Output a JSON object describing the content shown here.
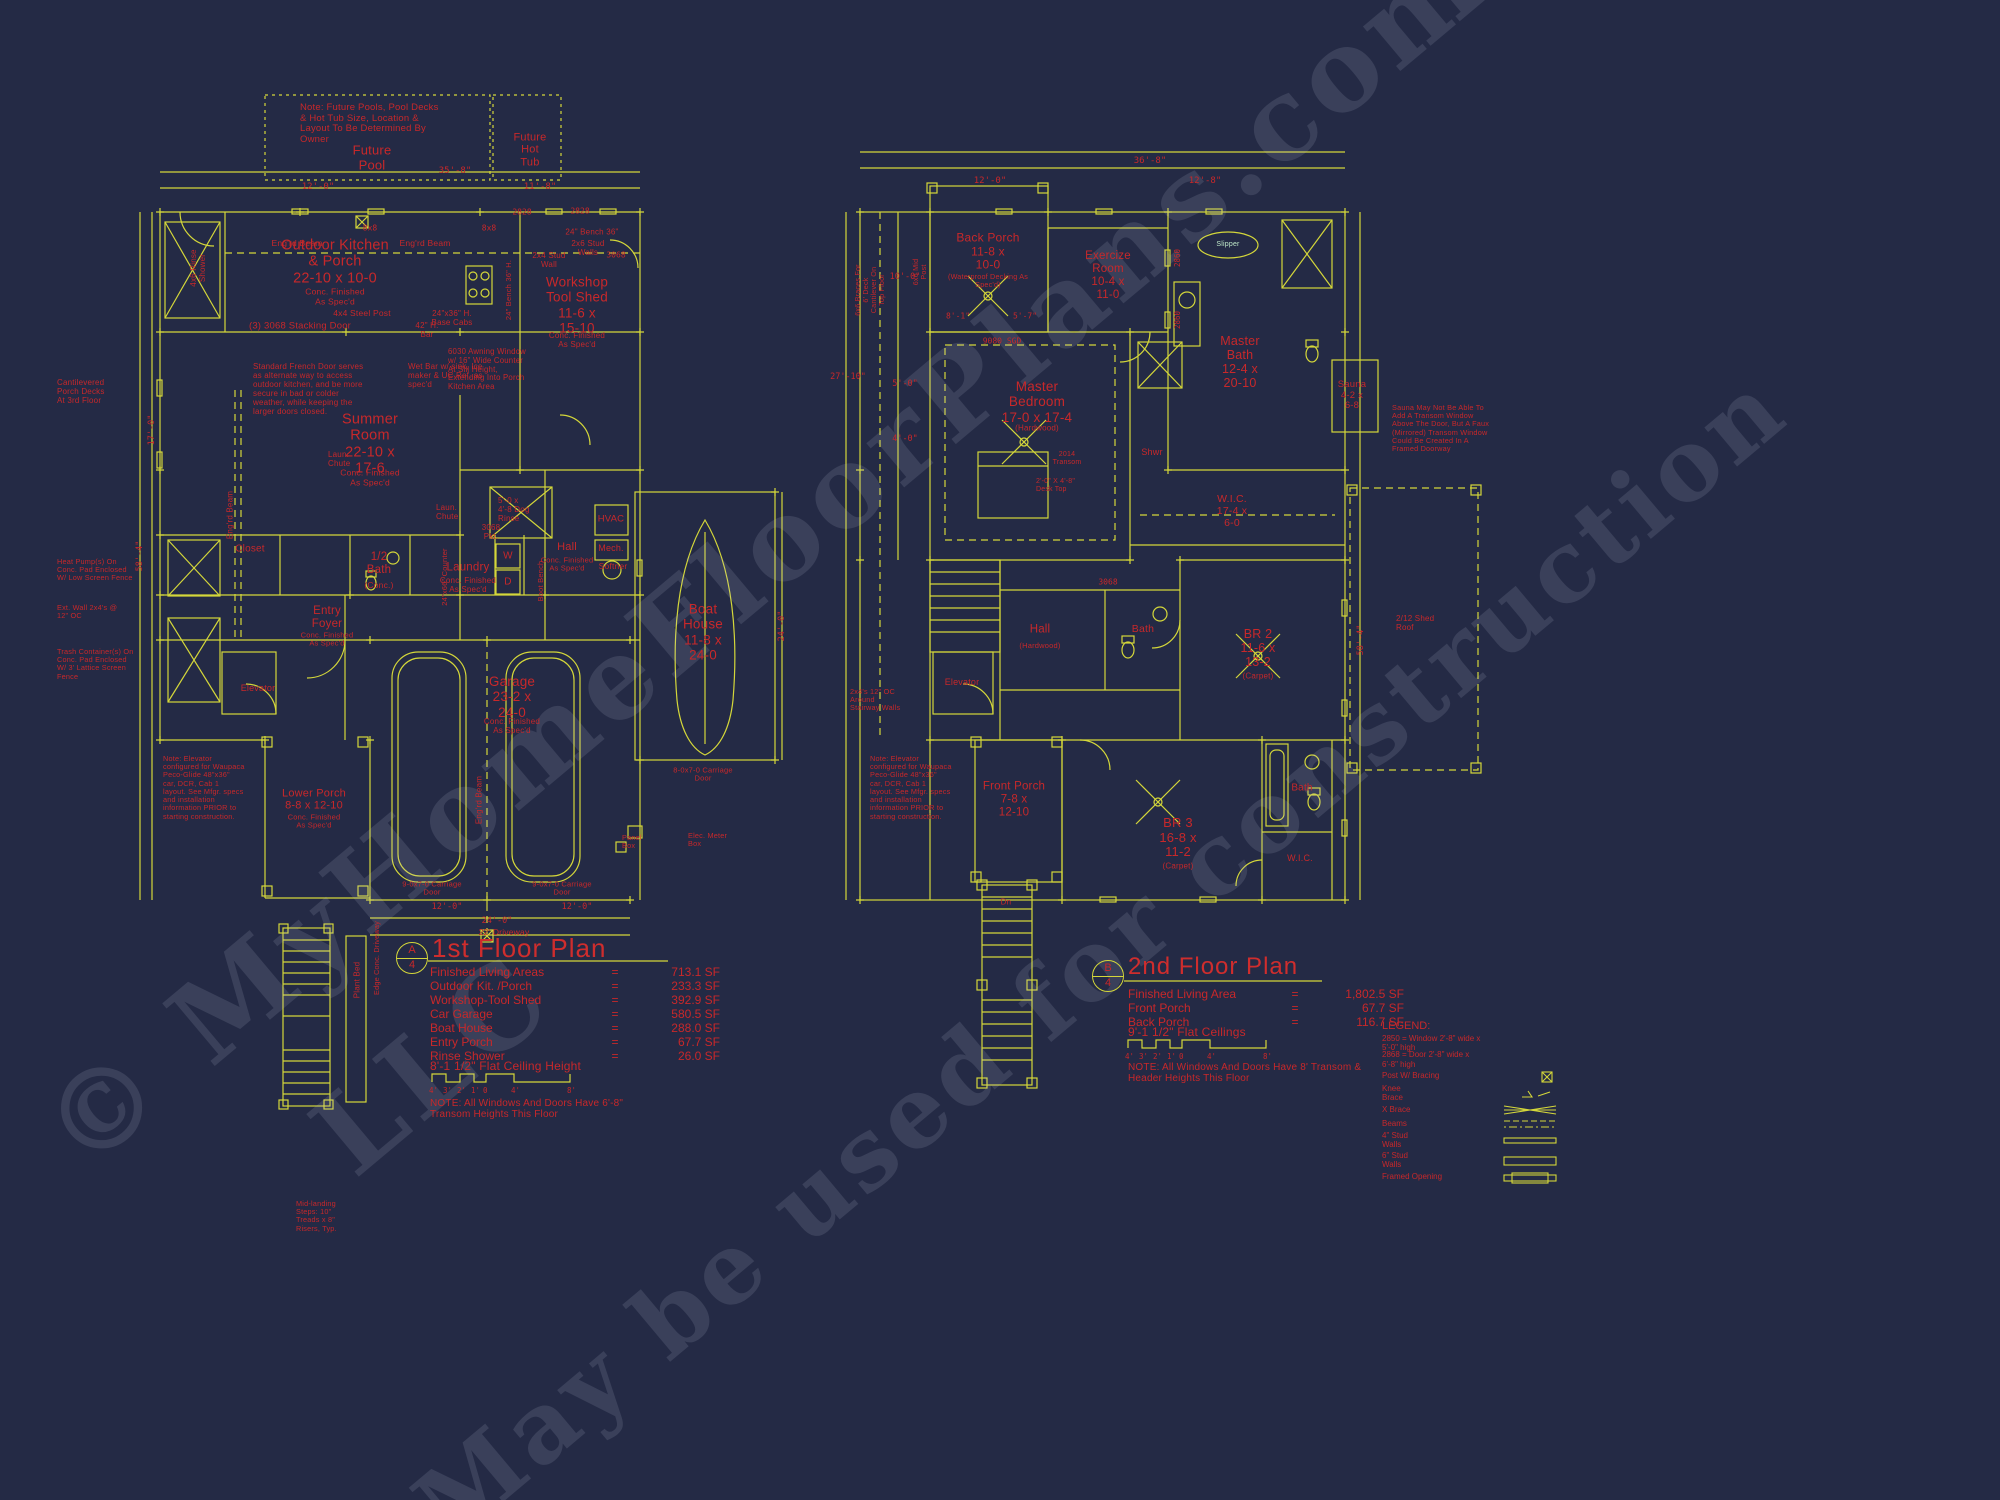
{
  "wm": {
    "l1": "© MyHomeFloorPlans.com",
    "l2": "LLC",
    "l3": "May be used for construction"
  },
  "p1": {
    "future_note": "Note: Future Pools, Pool Decks\n& Hot Tub Size, Location &\nLayout To Be Determined By\nOwner",
    "future_pool": "Future\nPool",
    "future_hot_tub": "Future\nHot\nTub",
    "outdoor_kitchen": "Outdoor Kitchen\n& Porch\n22-10 x 10-0",
    "outdoor_kitchen_fin": "Conc. Finished\nAs Spec'd",
    "workshop": "Workshop\nTool Shed\n11-6 x\n15-10",
    "workshop_fin": "Conc. Finished\nAs Spec'd",
    "summer_room": "Summer\nRoom\n22-10 x\n17-6",
    "summer_room_fin": "Conc. Finished\nAs Spec'd",
    "entry_foyer": "Entry\nFoyer",
    "entry_foyer_fin": "Conc. Finished\nAs Spec'd",
    "closet": "Closet",
    "elevator": "Elevator",
    "half_bath": "1/2\nBath",
    "half_bath_fin": "(Conc.)",
    "laundry": "Laundry",
    "laundry_fin": "Conc. Finished\nAs Spec'd",
    "washer": "W",
    "dryer": "D",
    "hall": "Hall",
    "hall_fin": "Conc. Finished\nAs Spec'd",
    "dog_rinse": "5'-0 x\n4'-8 Dog\nRinse",
    "hvac": "HVAC",
    "mech": "Mech.",
    "softner": "Softner",
    "boat_house": "Boat\nHouse\n11-8 x\n24-0",
    "boot_bench": "Boot Bench",
    "garage": "Garage\n23-2 x\n24-0",
    "garage_fin": "Conc. Finished\nAs Spec'd",
    "lower_porch": "Lower Porch\n8-8 x 12-10",
    "lower_porch_fin": "Conc. Finished\nAs Spec'd",
    "rinse_shower": "4x6 Rinse\nShower",
    "notes": {
      "cantilever": "Cantilevered\nPorch Decks\nAt 3rd Floor",
      "heat_pump": "Heat Pump(s) On\nConc. Pad Enclosed\nW/ Low Screen Fence",
      "ext_wall": "Ext. Wall 2x4's @\n12\" OC",
      "trash": "Trash Container(s) On\nConc. Pad Enclosed\nW/ 3' Lattice Screen\nFence",
      "elevator_note": "Note: Elevator\nconfigured for Waupaca\nPeco-Glide 48\"x36\"\ncar, DCR, Cab 1\nlayout. See Mfgr. specs\nand installation\ninformation PRIOR to\nstarting construction.",
      "french_door": "Standard French Door serves\nas alternate way to access\noutdoor kitchen, and be more\nsecure in bad or colder\nweather, while keeping the\nlarger doors closed.",
      "awning": "6030 Awning Window\nw/ 16\" Wide Counter\nAt Sill Height,\nExtending Into Porch\nKitchen Area",
      "base_cabs": "24\"x36\" H.\nBase Cabs",
      "stacking_door": "(3) 3068 Stacking Door",
      "steel_post": "4x4 Steel Post",
      "engrd_beam": "Eng'rd Beam",
      "bench24": "24\" Bench 36\"",
      "stud_walls": "2x6 Stud\nWalls",
      "stud24": "2x4 Stud\nWall",
      "bench_vert": "24\" Bench 36\" H.",
      "wet_bar": "Wet Bar w/ sink, Ice\nmaker & UC Ref. as\nspec'd",
      "bar42": "42\" H.\nBar",
      "laun_chute": "Laun.\nChute",
      "counter24": "24\"x66\" Counter",
      "mid_landing": "Mid-landing\nSteps: 10\"\nTreads x 8\"\nRisers, Typ.",
      "plant_bed": "Plant Bed",
      "edge_conc": "Edge Conc. Driveway",
      "elec_meter": "Elec. Meter\nBox",
      "panel_box": "Panel\nBox",
      "driveway": "22' Driveway"
    },
    "dims": {
      "top_l": "12'-0\"",
      "top_r": "11'-8\"",
      "top_total": "35'-8\"",
      "left_total": "58'-4\"",
      "left_mid": "17'-0\"",
      "boat_r": "24'-0\"",
      "gar_l": "12'-0\"",
      "gar_r": "12'-0\"",
      "gar_total": "24'-0\""
    },
    "codes": {
      "w2828a": "2828",
      "w2828b": "2828",
      "d3068a": "3068",
      "pkt": "3068\nPkt.",
      "p8x8a": "8x8",
      "p8x8b": "8x8",
      "carriage_l": "9-0x7-0 Carriage\nDoor",
      "carriage_r": "9-0x7-0 Carriage\nDoor",
      "boat_door": "8-0x7-0 Carriage\nDoor"
    },
    "title": "1st Floor Plan",
    "marker_letter": "A",
    "marker_number": "4",
    "summary": {
      "rows": [
        {
          "label": "Finished Living Areas",
          "eq": "=",
          "value": "713.1 SF"
        },
        {
          "label": "Outdoor Kit. /Porch",
          "eq": "=",
          "value": "233.3 SF"
        },
        {
          "label": "Workshop-Tool Shed",
          "eq": "=",
          "value": "392.9 SF"
        },
        {
          "label": "Car Garage",
          "eq": "=",
          "value": "580.5 SF"
        },
        {
          "label": "Boat House",
          "eq": "=",
          "value": "288.0 SF"
        },
        {
          "label": "Entry Porch",
          "eq": "=",
          "value": "67.7 SF"
        },
        {
          "label": "Rinse Shower",
          "eq": "=",
          "value": "26.0 SF"
        }
      ],
      "ceiling": "8'-1 1/2\" Flat Ceiling Height",
      "note": "NOTE: All Windows And Doors Have 6'-8\"\nTransom Heights This Floor"
    },
    "scale": [
      "4'",
      "3'",
      "2'",
      "1'",
      "0",
      "4'",
      "8'"
    ]
  },
  "p2": {
    "back_porch": "Back Porch\n11-8 x\n10-0",
    "back_porch_fin": "(Waterproof Decking As\nSpec'd)",
    "exercise": "Exercize\nRoom\n10-4 x\n11-0",
    "slipper": "Slipper",
    "master_bath": "Master\nBath\n12-4 x\n20-10",
    "sauna": "Sauna\n4-2 x\n6-8",
    "master_bedroom": "Master\nBedroom\n17-0 x 17-4",
    "master_bedroom_fin": "(Hardwood)",
    "shwr": "Shwr",
    "wic": "W.I.C.\n17-4 x\n6-0",
    "hall": "Hall",
    "hall_fin": "(Hardwood)",
    "bath2": "Bath",
    "br2": "BR 2\n11-6 x\n13-2",
    "br2_fin": "(Carpet)",
    "elevator": "Elevator",
    "front_porch": "Front Porch\n7-8 x\n12-10",
    "br3": "BR 3\n16-8 x\n11-2",
    "br3_fin": "(Carpet)",
    "bath3": "Bath",
    "wic3": "W.I.C.",
    "dn": "Dn",
    "notes": {
      "sauna_note": "Sauna May Not Be Able To\nAdd A Transom Window\nAbove The Door, But A Faux\n(Mirrored) Transom Window\nCould Be Created In A\nFramed Doorway",
      "stair_walls": "2x4's 12\" OC\nAround\nStairway Walls",
      "elevator_note": "Note: Elevator\nconfigured for Waupaca\nPeco-Glide 48\"x36\"\ncar, DCR, Cab 1\nlayout. See Mfgr. specs\nand installation\ninformation PRIOR to\nstarting construction.",
      "braces": "6x6 Braces For\n6' Deck\nCantilever On\nTop Floor",
      "mid_post": "6x6 Mid\nPost",
      "shed_roof": "2/12 Shed\nRoof"
    },
    "dims": {
      "d10": "10'-0\"",
      "d5": "5'-0\"",
      "d4": "4'-0\"",
      "d27": "27'-10\"",
      "d81": "8'-1\"",
      "d57": "5'-7\"",
      "right": "58'-4\"",
      "top_l": "12'-0\"",
      "top_r": "12'-8\"",
      "top_total": "36'-8\""
    },
    "codes": {
      "sgd": "9080 SGD",
      "transom": "2014\nTransom",
      "desk": "2'-0\" X 4'-8\"\nDesk Top",
      "w2860a": "2860",
      "w2860b": "2860",
      "d3068": "3068"
    },
    "title": "2nd Floor Plan",
    "marker_letter": "B",
    "marker_number": "4",
    "summary": {
      "rows": [
        {
          "label": "Finished Living Area",
          "eq": "=",
          "value": "1,802.5 SF"
        },
        {
          "label": "Front Porch",
          "eq": "=",
          "value": "67.7 SF"
        },
        {
          "label": "Back  Porch",
          "eq": "=",
          "value": "116.7 SF"
        }
      ],
      "ceiling": "9'-1 1/2\" Flat Ceilings",
      "note": "NOTE: All Windows And Doors Have 8' Transom &\nHeader Heights This Floor"
    },
    "scale": [
      "4'",
      "3'",
      "2'",
      "1'",
      "0",
      "4'",
      "8'"
    ]
  },
  "legend": {
    "title": "LEGEND:",
    "win": "2850 = Window 2'-8\" wide x\n5'-0\" high",
    "door": "2868 = Door 2'-8\" wide x\n6'-8\" high",
    "post": "Post W/ Bracing",
    "knee": "Knee\nBrace",
    "xbrace": "X Brace",
    "beams": "Beams",
    "stud4": "4\" Stud\nWalls",
    "stud6": "6\" Stud\nWalls",
    "framed": "Framed Opening"
  }
}
